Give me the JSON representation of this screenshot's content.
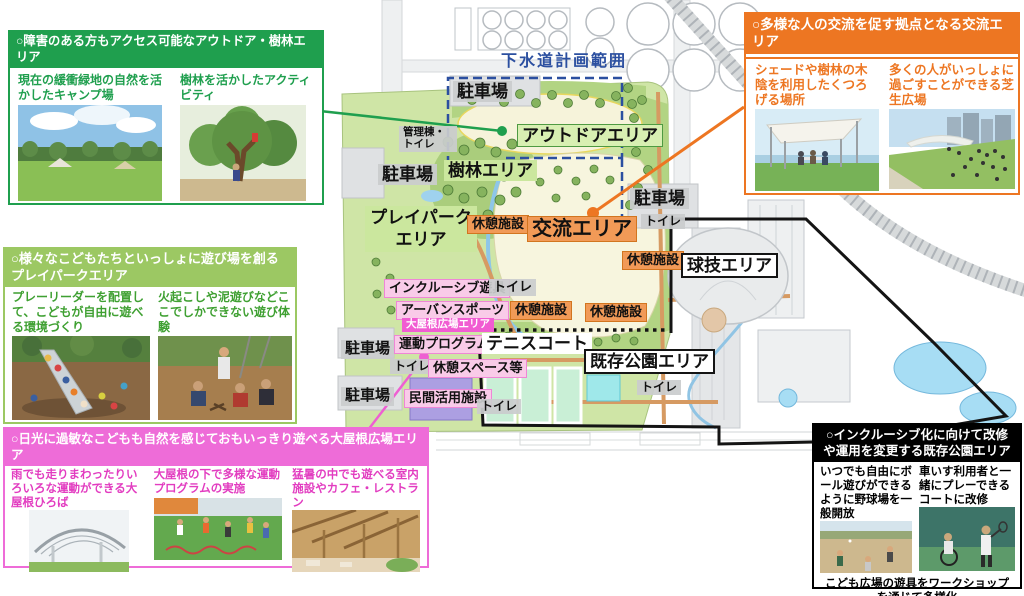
{
  "callouts": {
    "outdoor_forest": {
      "title": "○障害のある方もアクセス可能なアウトドア・樹林エリア",
      "captions": [
        "現在の緩衝緑地の自然を活かしたキャンプ場",
        "樹林を活かしたアクティビティ"
      ],
      "accent_color": "#1f9f4e"
    },
    "playpark": {
      "title": "○様々なこどもたちといっしょに遊び場を創る プレイパークエリア",
      "captions": [
        "プレーリーダーを配置して、こどもが自由に遊べる環境づくり",
        "火起こしや泥遊びなどここでしかできない遊び体験"
      ],
      "accent_color": "#9cc863"
    },
    "big_roof_plaza": {
      "title": "○日光に過敏なこどもも自然を感じておもいっきり遊べる大屋根広場エリア",
      "captions": [
        "雨でも走りまわったりいろいろな運動ができる大屋根ひろば",
        "大屋根の下で多様な運動プログラムの実施",
        "猛暑の中でも遊べる室内施設やカフェ・レストラン"
      ],
      "accent_color": "#ee6cd8"
    },
    "exchange": {
      "title": "○多様な人の交流を促す拠点となる交流エリア",
      "captions": [
        "シェードや樹林の木陰を利用したくつろげる場所",
        "多くの人がいっしょに過ごすことができる芝生広場"
      ],
      "accent_color": "#ed7622"
    },
    "existing_park": {
      "title": "○インクルーシブ化に向けて改修や運用を変更する既存公園エリア",
      "captions": [
        "いつでも自由にボール遊びができるように野球場を一般開放",
        "車いす利用者と一緒にプレーできるコートに改修"
      ],
      "bottom_caption": "こども広場の遊具をワークショップを通じて多様化",
      "accent_color": "#000000"
    }
  },
  "map": {
    "plan_range_label": "下水道計画範囲",
    "labels": [
      "駐車場",
      "管理棟・トイレ",
      "アウトドアエリア",
      "樹林エリア",
      "駐車場",
      "プレイパークエリア",
      "休憩施設",
      "交流エリア",
      "駐車場",
      "トイレ",
      "休憩施設",
      "球技エリア",
      "インクルーシブ遊具",
      "トイレ",
      "アーバンスポーツ",
      "休憩施設",
      "休憩施設",
      "大屋根広場エリア",
      "運動プログラム",
      "テニスコート",
      "駐車場",
      "トイレ",
      "休憩スペース等",
      "既存公園エリア",
      "駐車場",
      "民間活用施設",
      "トイレ",
      "トイレ"
    ],
    "label_colors": {
      "gray_bg": "#cacccd",
      "green_bg": "#cbe79e",
      "orange_bg": "#f19a57",
      "pink_bg": "#f9cbe8",
      "magenta_bg": "#f15cd2",
      "plan_range_text": "#2b4fa0"
    }
  }
}
